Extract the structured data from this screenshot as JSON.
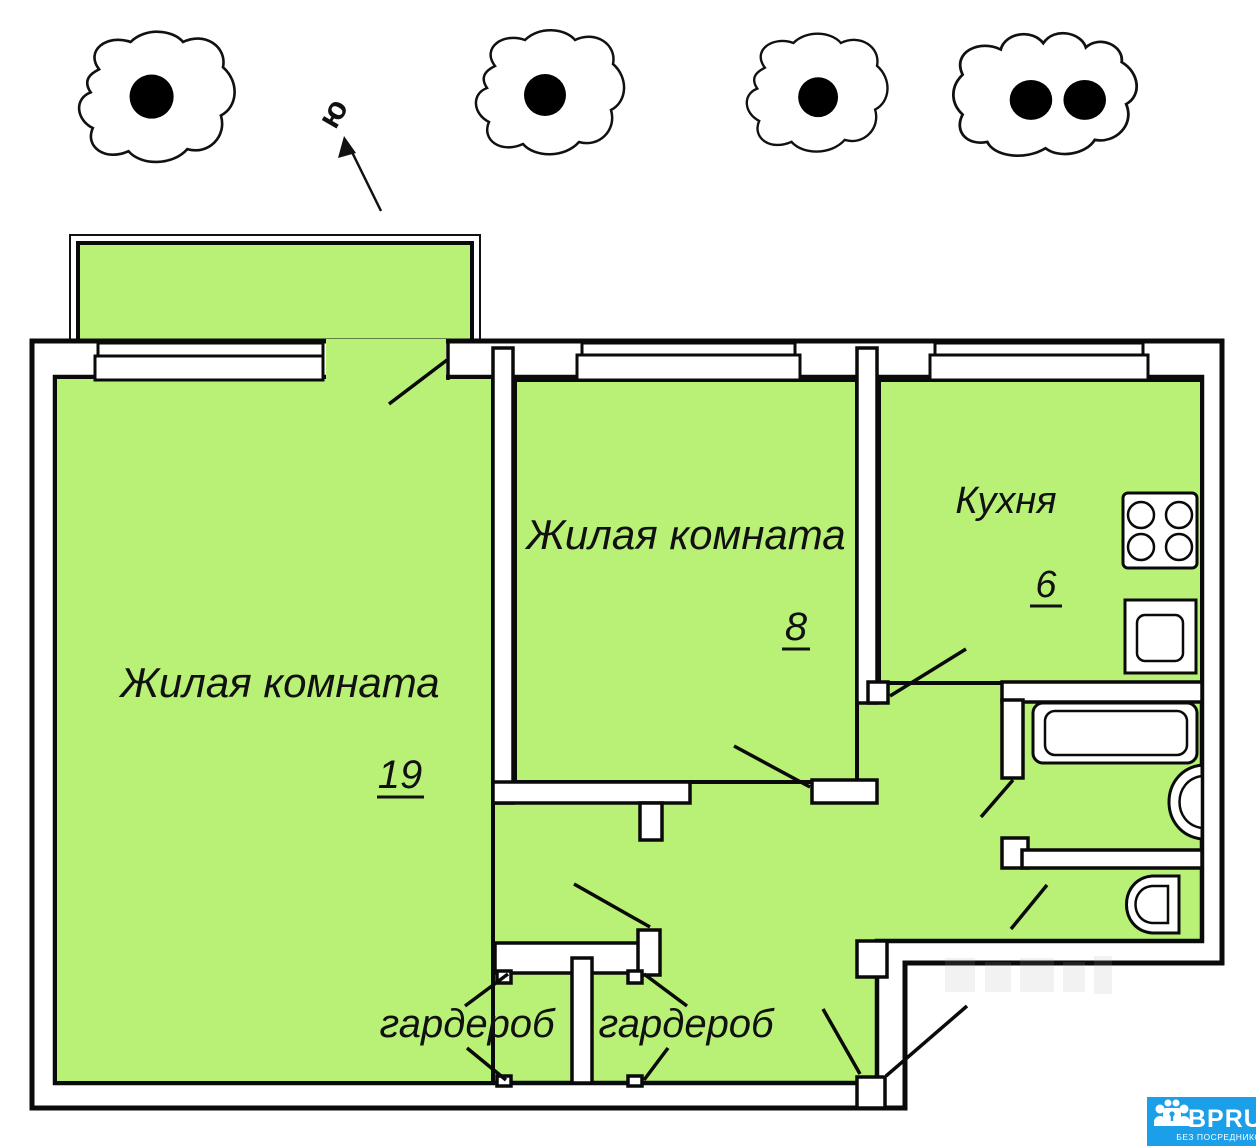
{
  "plan": {
    "compass_label": "ю",
    "fill_color": "#b9f177",
    "line_color": "#0a0a0a",
    "rooms": [
      {
        "label": "Жилая комната",
        "area": "19"
      },
      {
        "label": "Жилая комната",
        "area": "8"
      },
      {
        "label": "Кухня",
        "area": "6"
      },
      {
        "label": "гардероб",
        "area": ""
      },
      {
        "label": "гардероб",
        "area": ""
      }
    ],
    "icons": [
      "tree-symbol",
      "tree-symbol",
      "tree-symbol",
      "tree-symbol",
      "north-arrow",
      "window-symbol",
      "door-swing",
      "stove-icon",
      "kitchen-sink-icon",
      "bathtub-icon",
      "washbasin-icon",
      "toilet-icon"
    ]
  },
  "branding": {
    "logo_text": "BPRU",
    "logo_subtext": "БЕЗ ПОСРЕДНИКОВ",
    "brand_color": "#1a9fe8"
  }
}
